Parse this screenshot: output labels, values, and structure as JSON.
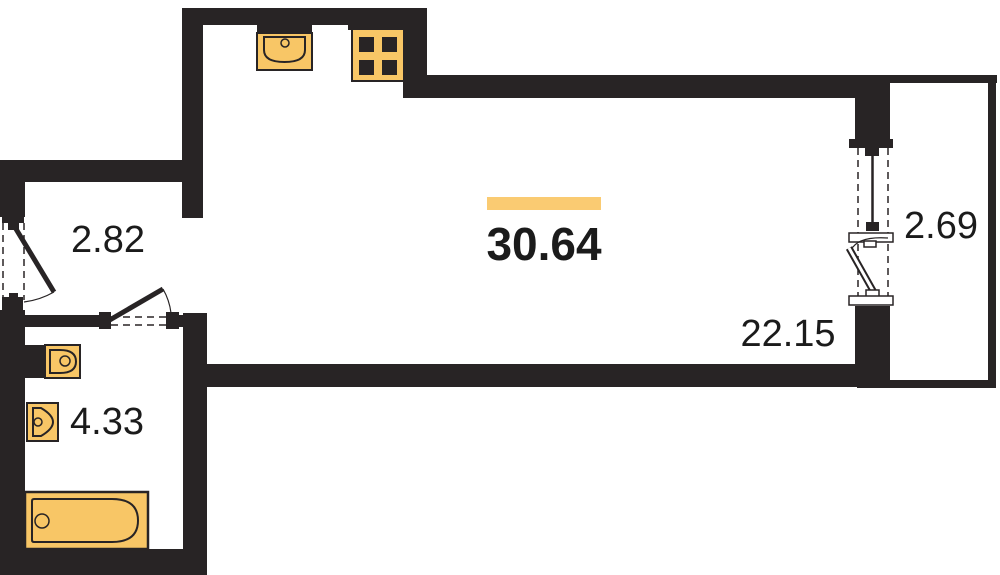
{
  "floorplan": {
    "total_area": "30.64",
    "rooms": {
      "hallway": {
        "area": "2.82"
      },
      "main_room": {
        "area": "22.15"
      },
      "bathroom": {
        "area": "4.33"
      },
      "balcony": {
        "area": "2.69"
      }
    },
    "fixtures": [
      {
        "name": "kitchen-sink"
      },
      {
        "name": "stove"
      },
      {
        "name": "toilet"
      },
      {
        "name": "washbasin"
      },
      {
        "name": "bathtub"
      }
    ],
    "colors": {
      "wall": "#282425",
      "fixture_fill": "#F8C666",
      "accent_bar": "#FACB72",
      "label_text": "#1B1B1B",
      "background": "#FFFFFF"
    }
  }
}
